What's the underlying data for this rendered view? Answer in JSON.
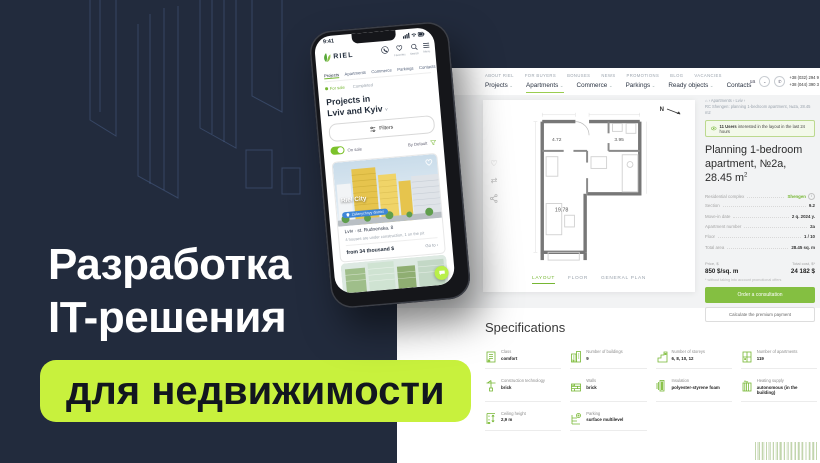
{
  "hero": {
    "title_line1": "Разработка",
    "title_line2": "IT-решения",
    "badge": "для недвижимости"
  },
  "colors": {
    "navy_bg": "#222b3d",
    "banner_lime": "#c8f13d",
    "site_green": "#76b733",
    "pill_blue": "#3e86d8"
  },
  "phone": {
    "status_time": "9:41",
    "logo": "RIEL",
    "header_icons": {
      "favorites": "Favorites",
      "search": "Search",
      "menu": "Menu"
    },
    "nav": [
      "Projects",
      "Apartments",
      "Commerce",
      "Parkings",
      "Contacts"
    ],
    "filter_tabs": {
      "for_sale": "For sale",
      "completed": "Completed"
    },
    "title_line1": "Projects in",
    "title_line2": "Lviv and Kyiv",
    "filters_button": "Filters",
    "toggle_label": "On sale",
    "sort_label": "By Default",
    "card": {
      "name": "Riel City",
      "district": "Zaliznychnyy district",
      "address": "Lviv · st. Rudnenska, 8",
      "status": "4 houses are under construction, 1 on the pit",
      "price": "from 34 thousand $",
      "cta": "Go to ›"
    }
  },
  "desktop": {
    "utility_links": [
      "ABOUT RIEL",
      "FOR BUYERS",
      "BONUSES",
      "NEWS",
      "PROMOTIONS",
      "BLOG",
      "VACANCIES"
    ],
    "nav": [
      "Projects",
      "Apartments",
      "Commerce",
      "Parkings",
      "Ready objects",
      "Contacts"
    ],
    "lang": "ua",
    "phone_numbers": [
      "+38 (032) 294 9",
      "+38 (044) 390 3"
    ],
    "breadcrumb": {
      "line1": "⌂  ›  Apartments  ›  Lviv  ›",
      "line2": "RC Shengen: planning 1-bedroom apartment, №2a, 28.45 m2"
    },
    "views_badge": {
      "count": "11 Users",
      "text": "interested in the layout in the last 24 hours"
    },
    "plan_title": {
      "main": "Planning 1-bedroom apartment, №2a, 28.45 m",
      "sup": "2"
    },
    "details_rows": [
      {
        "label": "Residential complex",
        "value": "Shengen"
      },
      {
        "label": "Section",
        "value": "9.2"
      },
      {
        "label": "Move-in date",
        "value": "2 q. 2024 y."
      },
      {
        "label": "Apartment number",
        "value": "2a"
      },
      {
        "label": "Floor",
        "value": "1 / 10"
      },
      {
        "label": "Total area",
        "value": "28.45 sq. m"
      }
    ],
    "price": {
      "label": "Price, $",
      "value": "850 $/sq. m",
      "total_label": "Total cost, $*",
      "total_value": "24 182 $",
      "footnote": "* without taking into account promotional offers"
    },
    "buttons": {
      "primary": "Order a consultation",
      "secondary": "Calculate the premium payment"
    },
    "plan": {
      "tabs": [
        "LAYOUT",
        "FLOOR",
        "GENERAL PLAN"
      ],
      "compass": "N",
      "rooms": [
        "4.72",
        "3.95",
        "19.78"
      ]
    },
    "specs": {
      "title": "Specifications",
      "items": [
        {
          "label": "Class",
          "value": "comfort",
          "icon": "class-icon"
        },
        {
          "label": "Number of buildings",
          "value": "9",
          "icon": "buildings-count-icon"
        },
        {
          "label": "Number of storeys",
          "value": "6, 8, 10, 12",
          "icon": "storeys-icon"
        },
        {
          "label": "Number of apartments",
          "value": "119",
          "icon": "apartments-count-icon"
        },
        {
          "label": "Construction technology",
          "value": "brick",
          "icon": "construction-technology-icon"
        },
        {
          "label": "Walls",
          "value": "brick",
          "icon": "walls-icon"
        },
        {
          "label": "Insulation",
          "value": "polyester-styrene foam",
          "icon": "insulation-icon"
        },
        {
          "label": "Heating supply",
          "value": "autonomous (in the building)",
          "icon": "heating-supply-icon"
        },
        {
          "label": "Ceiling height",
          "value": "2,9 m",
          "icon": "ceiling-height-icon"
        },
        {
          "label": "Parking",
          "value": "surface multilevel",
          "icon": "parking-icon"
        }
      ]
    }
  }
}
